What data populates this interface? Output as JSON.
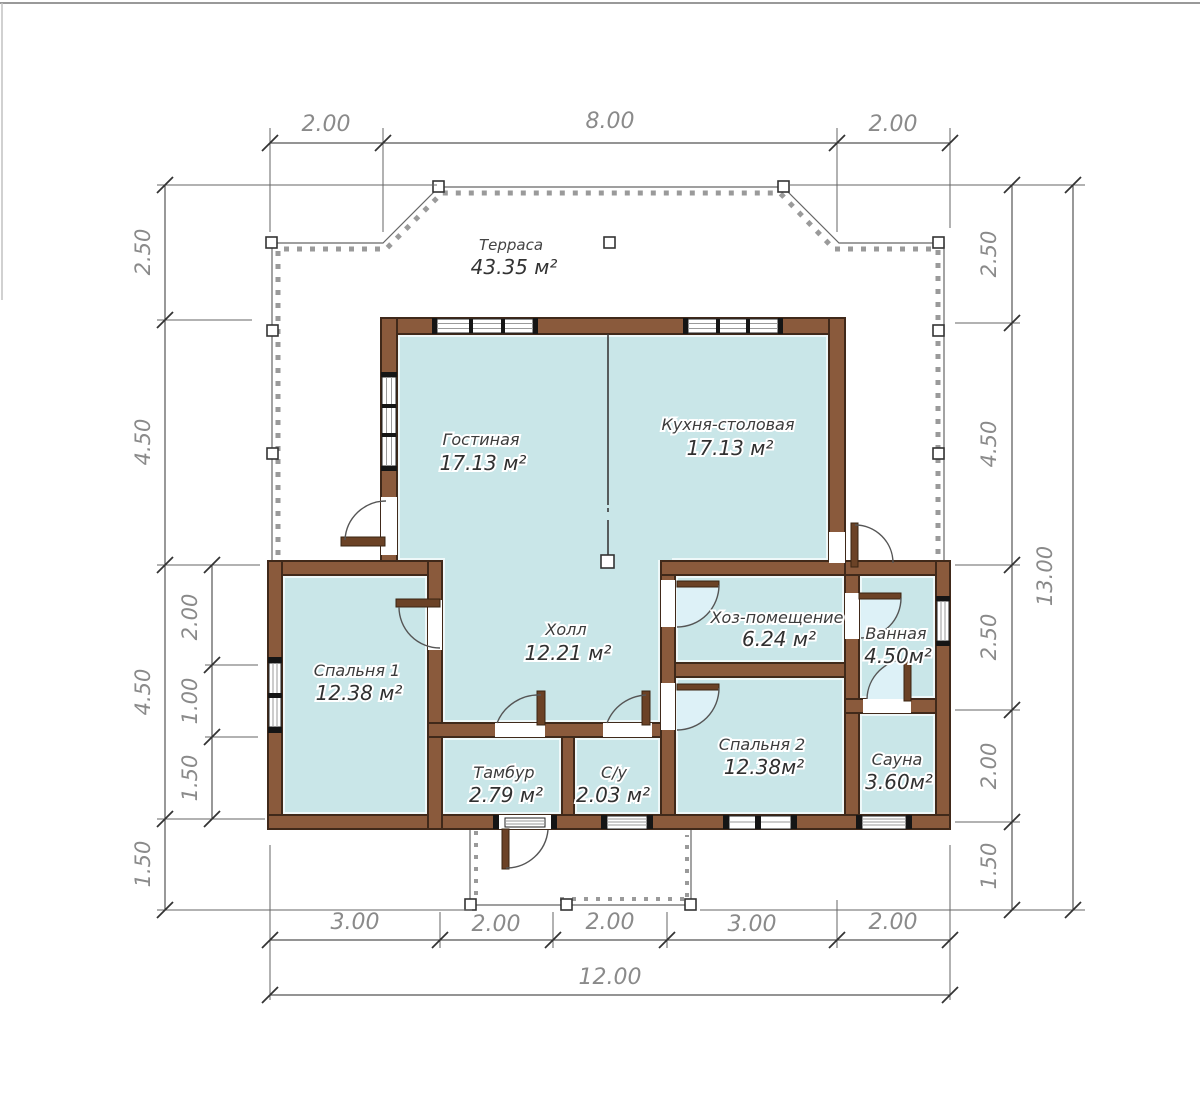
{
  "plan_title": "Floor plan (single-storey house)",
  "rooms": {
    "terrace": {
      "name": "Терраса",
      "area": "43.35 м²"
    },
    "living": {
      "name": "Гостиная",
      "area": "17.13 м²"
    },
    "kitchen": {
      "name": "Кухня-столовая",
      "area": "17.13 м²"
    },
    "hall": {
      "name": "Холл",
      "area": "12.21 м²"
    },
    "utility": {
      "name": "Хоз-помещение",
      "area": "6.24 м²"
    },
    "bathroom": {
      "name": "Ванная",
      "area": "4.50м²"
    },
    "bedroom1": {
      "name": "Спальня 1",
      "area": "12.38 м²"
    },
    "bedroom2": {
      "name": "Спальня 2",
      "area": "12.38м²"
    },
    "sauna": {
      "name": "Сауна",
      "area": "3.60м²"
    },
    "vestibule": {
      "name": "Тамбур",
      "area": "2.79 м²"
    },
    "wc": {
      "name": "С/у",
      "area": "2.03 м²"
    }
  },
  "dims": {
    "top": [
      "2.00",
      "8.00",
      "2.00"
    ],
    "left_outer": [
      "2.50",
      "4.50",
      "4.50",
      "1.50"
    ],
    "left_inner": [
      "2.00",
      "1.00",
      "1.50"
    ],
    "right_inner": [
      "2.50",
      "4.50",
      "2.50",
      "2.00",
      "1.50"
    ],
    "right_total": "13.00",
    "bottom": [
      "3.00",
      "2.00",
      "2.00",
      "3.00",
      "2.00"
    ],
    "bottom_total": "12.00"
  },
  "colors": {
    "wall_brown": "#8a5a3c",
    "wall_edge": "#40291a",
    "floor_cyan": "#c9e6e8",
    "dimension_gray": "#8a8a8a",
    "terrace_dot_gray": "#9a9a9a"
  }
}
